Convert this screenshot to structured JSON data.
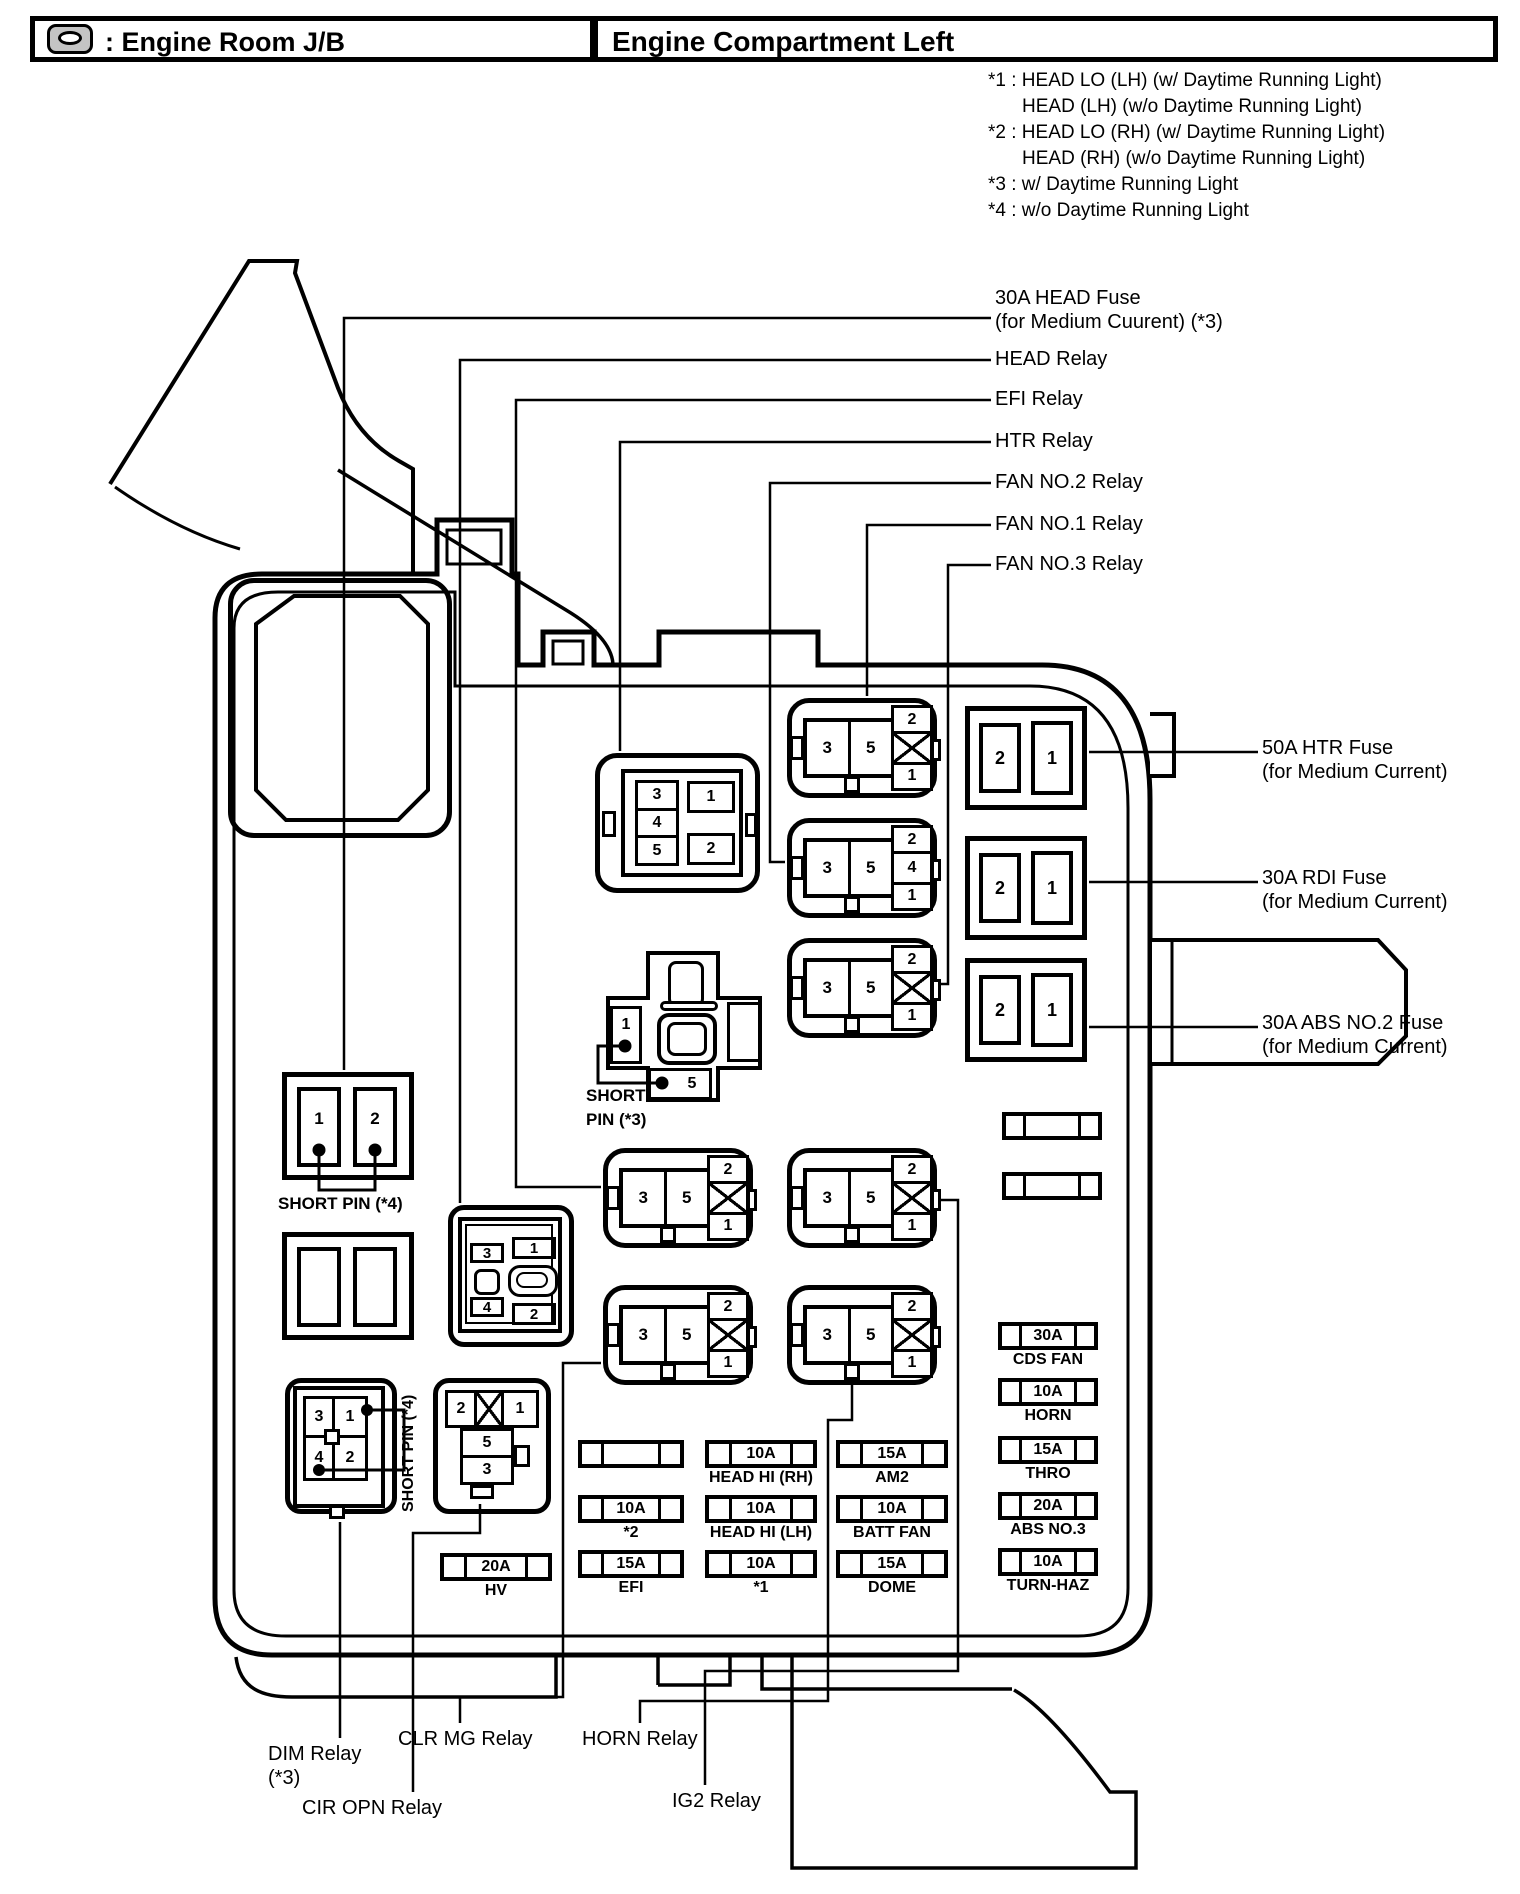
{
  "header": {
    "icon": "engine-room-jb-icon",
    "left_title": ": Engine Room J/B",
    "right_title": "Engine Compartment Left"
  },
  "notes": [
    {
      "indent": false,
      "text": "*1 : HEAD LO (LH) (w/ Daytime Running Light)"
    },
    {
      "indent": true,
      "text": "HEAD (LH) (w/o Daytime Running Light)"
    },
    {
      "indent": false,
      "text": "*2 : HEAD LO (RH) (w/ Daytime Running Light)"
    },
    {
      "indent": true,
      "text": "HEAD (RH) (w/o Daytime Running Light)"
    },
    {
      "indent": false,
      "text": "*3 : w/ Daytime Running Light"
    },
    {
      "indent": false,
      "text": "*4 : w/o Daytime Running Light"
    }
  ],
  "callouts": [
    {
      "name": "head-fuse-30a-callout",
      "x": 995,
      "y": 286,
      "lines": [
        "30A HEAD Fuse",
        "(for Medium Cuurent) (*3)"
      ],
      "points": [
        [
          991,
          318
        ],
        [
          344,
          318
        ],
        [
          344,
          1070
        ]
      ]
    },
    {
      "name": "head-relay-callout",
      "x": 995,
      "y": 347,
      "lines": [
        "HEAD Relay"
      ],
      "points": [
        [
          991,
          360
        ],
        [
          460,
          360
        ],
        [
          460,
          1203
        ]
      ]
    },
    {
      "name": "efi-relay-callout",
      "x": 995,
      "y": 387,
      "lines": [
        "EFI Relay"
      ],
      "points": [
        [
          991,
          400
        ],
        [
          516,
          400
        ],
        [
          516,
          1187
        ],
        [
          601,
          1187
        ]
      ]
    },
    {
      "name": "htr-relay-callout",
      "x": 995,
      "y": 429,
      "lines": [
        "HTR Relay"
      ],
      "points": [
        [
          991,
          442
        ],
        [
          620,
          442
        ],
        [
          620,
          751
        ]
      ]
    },
    {
      "name": "fan-no2-relay-callout",
      "x": 995,
      "y": 470,
      "lines": [
        "FAN NO.2 Relay"
      ],
      "points": [
        [
          991,
          483
        ],
        [
          770,
          483
        ],
        [
          770,
          862
        ],
        [
          785,
          862
        ]
      ]
    },
    {
      "name": "fan-no1-relay-callout",
      "x": 995,
      "y": 512,
      "lines": [
        "FAN NO.1 Relay"
      ],
      "points": [
        [
          991,
          525
        ],
        [
          867,
          525
        ],
        [
          867,
          696
        ]
      ]
    },
    {
      "name": "fan-no3-relay-callout",
      "x": 995,
      "y": 552,
      "lines": [
        "FAN NO.3 Relay"
      ],
      "points": [
        [
          991,
          565
        ],
        [
          948,
          565
        ],
        [
          948,
          984
        ],
        [
          939,
          984
        ]
      ]
    },
    {
      "name": "htr-fuse-50a-callout",
      "x": 1262,
      "y": 736,
      "lines": [
        "50A HTR Fuse",
        "(for Medium Current)"
      ],
      "points": [
        [
          1089,
          752
        ],
        [
          1258,
          752
        ]
      ]
    },
    {
      "name": "rdi-fuse-30a-callout",
      "x": 1262,
      "y": 866,
      "lines": [
        "30A RDI Fuse",
        "(for Medium Current)"
      ],
      "points": [
        [
          1089,
          882
        ],
        [
          1258,
          882
        ]
      ]
    },
    {
      "name": "abs-no2-fuse-30a-callout",
      "x": 1262,
      "y": 1011,
      "lines": [
        "30A ABS NO.2 Fuse",
        "(for Medium Current)"
      ],
      "points": [
        [
          1089,
          1027
        ],
        [
          1258,
          1027
        ]
      ]
    },
    {
      "name": "dim-relay-callout",
      "x": 268,
      "y": 1742,
      "lines": [
        "DIM Relay",
        "(*3)"
      ],
      "points": [
        [
          340,
          1522
        ],
        [
          340,
          1738
        ]
      ]
    },
    {
      "name": "cir-opn-relay-callout",
      "x": 302,
      "y": 1796,
      "lines": [
        "CIR OPN Relay"
      ],
      "points": [
        [
          480,
          1504
        ],
        [
          480,
          1533
        ],
        [
          413,
          1533
        ],
        [
          413,
          1792
        ]
      ]
    },
    {
      "name": "clr-mg-relay-callout",
      "x": 398,
      "y": 1727,
      "lines": [
        "CLR MG Relay"
      ],
      "points": [
        [
          601,
          1363
        ],
        [
          563,
          1363
        ],
        [
          563,
          1697
        ],
        [
          460,
          1697
        ],
        [
          460,
          1723
        ]
      ]
    },
    {
      "name": "horn-relay-callout",
      "x": 582,
      "y": 1727,
      "lines": [
        "HORN Relay"
      ],
      "points": [
        [
          852,
          1383
        ],
        [
          852,
          1420
        ],
        [
          828,
          1420
        ],
        [
          828,
          1701
        ],
        [
          640,
          1701
        ],
        [
          640,
          1723
        ]
      ]
    },
    {
      "name": "ig2-relay-callout",
      "x": 672,
      "y": 1789,
      "lines": [
        "IG2 Relay"
      ],
      "points": [
        [
          935,
          1200
        ],
        [
          958,
          1200
        ],
        [
          958,
          1671
        ],
        [
          705,
          1671
        ],
        [
          705,
          1785
        ]
      ]
    }
  ],
  "relays_type_a": [
    {
      "name": "fan-no1-relay",
      "x": 787,
      "y": 698,
      "left_pins": [
        "3",
        "5"
      ],
      "stack": [
        "2",
        "X",
        "1"
      ]
    },
    {
      "name": "fan-no2-relay",
      "x": 787,
      "y": 818,
      "left_pins": [
        "3",
        "5"
      ],
      "stack": [
        "2",
        "4",
        "1"
      ]
    },
    {
      "name": "fan-no3-relay",
      "x": 787,
      "y": 938,
      "left_pins": [
        "3",
        "5"
      ],
      "stack": [
        "2",
        "X",
        "1"
      ]
    },
    {
      "name": "efi-relay",
      "x": 603,
      "y": 1148,
      "left_pins": [
        "3",
        "5"
      ],
      "stack": [
        "2",
        "X",
        "1"
      ]
    },
    {
      "name": "ig2-relay",
      "x": 787,
      "y": 1148,
      "left_pins": [
        "3",
        "5"
      ],
      "stack": [
        "2",
        "X",
        "1"
      ]
    },
    {
      "name": "clr-mg-relay",
      "x": 603,
      "y": 1285,
      "left_pins": [
        "3",
        "5"
      ],
      "stack": [
        "2",
        "X",
        "1"
      ]
    },
    {
      "name": "horn-relay",
      "x": 787,
      "y": 1285,
      "left_pins": [
        "3",
        "5"
      ],
      "stack": [
        "2",
        "X",
        "1"
      ]
    }
  ],
  "htr_relay": {
    "pins_left": [
      "3",
      "4",
      "5"
    ],
    "pins_right": [
      "1",
      "2"
    ]
  },
  "head_relay": {
    "pins": {
      "tl": "3",
      "tr": "1",
      "bl": "4",
      "br": "2"
    }
  },
  "dim_relay": {
    "pins": {
      "tl": "3",
      "tr": "1",
      "bl": "4",
      "br": "2"
    },
    "side_label": "SHORT PIN (*4)"
  },
  "cir_opn_relay": {
    "top_left": "2",
    "top_right": "1",
    "mid_top": "5",
    "mid_bottom": "3"
  },
  "short_pin_3": {
    "cell_left": "1",
    "cell_bottom": "5",
    "label_line1": "SHORT",
    "label_line2": "PIN (*3)"
  },
  "short_pin_4": {
    "cell_left": "1",
    "cell_right": "2",
    "label": "SHORT PIN (*4)"
  },
  "big_fuses": [
    {
      "name": "htr-50a-fuse",
      "x": 965,
      "y": 706,
      "cells": [
        "2",
        "1"
      ]
    },
    {
      "name": "rdi-30a-fuse",
      "x": 965,
      "y": 836,
      "cells": [
        "2",
        "1"
      ]
    },
    {
      "name": "abs-no2-30a-fuse",
      "x": 965,
      "y": 958,
      "cells": [
        "2",
        "1"
      ]
    }
  ],
  "fuse_strips": [
    {
      "name": "cds-fan-fuse",
      "x": 998,
      "y": 1322,
      "w": 100,
      "amp": "30A",
      "label": "CDS FAN"
    },
    {
      "name": "horn-fuse",
      "x": 998,
      "y": 1378,
      "w": 100,
      "amp": "10A",
      "label": "HORN"
    },
    {
      "name": "thro-fuse",
      "x": 998,
      "y": 1436,
      "w": 100,
      "amp": "15A",
      "label": "THRO"
    },
    {
      "name": "abs-no3-fuse",
      "x": 998,
      "y": 1492,
      "w": 100,
      "amp": "20A",
      "label": "ABS NO.3"
    },
    {
      "name": "turn-haz-fuse",
      "x": 998,
      "y": 1548,
      "w": 100,
      "amp": "10A",
      "label": "TURN-HAZ"
    },
    {
      "name": "blank-fuse-a",
      "x": 578,
      "y": 1440,
      "w": 106,
      "amp": "",
      "label": ""
    },
    {
      "name": "star2-fuse",
      "x": 578,
      "y": 1495,
      "w": 106,
      "amp": "10A",
      "label": "*2"
    },
    {
      "name": "efi-fuse",
      "x": 578,
      "y": 1550,
      "w": 106,
      "amp": "15A",
      "label": "EFI"
    },
    {
      "name": "head-hi-rh-fuse",
      "x": 705,
      "y": 1440,
      "w": 112,
      "amp": "10A",
      "label": "HEAD HI (RH)"
    },
    {
      "name": "head-hi-lh-fuse",
      "x": 705,
      "y": 1495,
      "w": 112,
      "amp": "10A",
      "label": "HEAD HI (LH)"
    },
    {
      "name": "star1-fuse",
      "x": 705,
      "y": 1550,
      "w": 112,
      "amp": "10A",
      "label": "*1"
    },
    {
      "name": "am2-fuse",
      "x": 836,
      "y": 1440,
      "w": 112,
      "amp": "15A",
      "label": "AM2"
    },
    {
      "name": "batt-fan-fuse",
      "x": 836,
      "y": 1495,
      "w": 112,
      "amp": "10A",
      "label": "BATT FAN"
    },
    {
      "name": "dome-fuse",
      "x": 836,
      "y": 1550,
      "w": 112,
      "amp": "15A",
      "label": "DOME"
    },
    {
      "name": "hv-fuse",
      "x": 440,
      "y": 1553,
      "w": 112,
      "amp": "20A",
      "label": "HV"
    },
    {
      "name": "blank-strip-upper",
      "x": 1002,
      "y": 1112,
      "w": 100,
      "amp": "",
      "label": ""
    },
    {
      "name": "blank-strip-lower",
      "x": 1002,
      "y": 1172,
      "w": 100,
      "amp": "",
      "label": ""
    }
  ]
}
